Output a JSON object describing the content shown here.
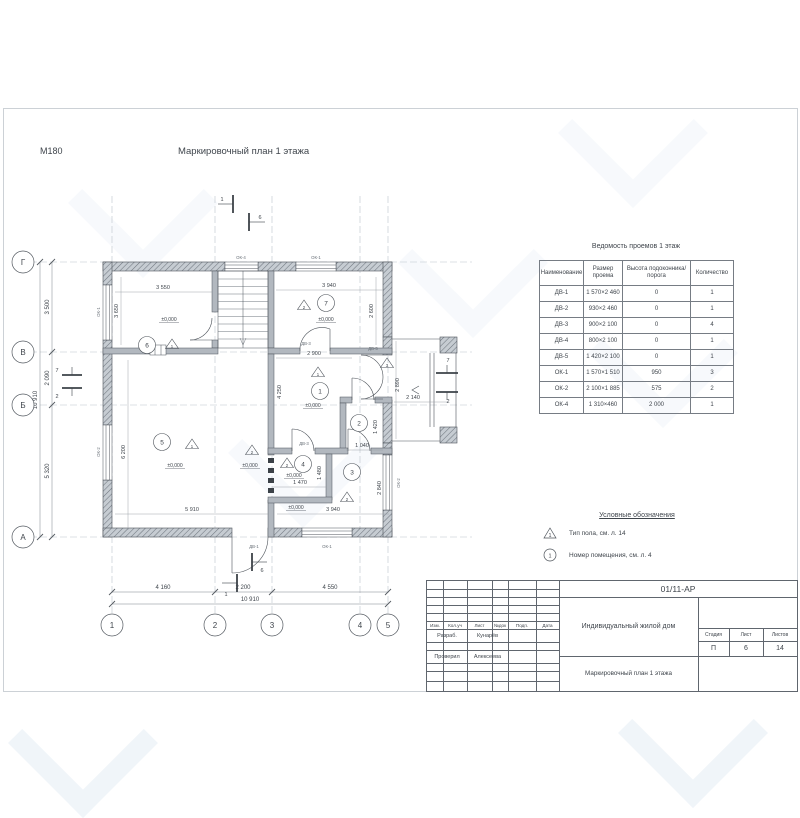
{
  "page": {
    "scale_label": "М180",
    "plan_title": "Маркировочный план 1 этажа"
  },
  "plan": {
    "axes_bottom": [
      "1",
      "2",
      "3",
      "4",
      "5"
    ],
    "axes_left": [
      "Г",
      "В",
      "Б",
      "А"
    ],
    "level": "±0,000",
    "room_numbers": [
      "1",
      "2",
      "3",
      "4",
      "5",
      "6",
      "7"
    ],
    "floor_types": [
      "1",
      "2",
      "3"
    ],
    "section_marks": {
      "s1": "1",
      "s6": "6",
      "s2": "2",
      "s7": "7"
    },
    "openings": {
      "ok1": "ОК-1",
      "ok2": "ОК-2",
      "ok4": "ОК-4",
      "dv1": "ДВ-1",
      "dv3": "ДВ-3",
      "dv5": "ДВ-5"
    },
    "dims": {
      "tl_w": "3 550",
      "tl_h": "3 650",
      "tr_w": "3 940",
      "tr_h": "2 600",
      "hall_w": "2 900",
      "hall_h": "4 250",
      "porch_h": "2 890",
      "porch_w": "2 140",
      "lobby_w": "1 040",
      "lobby_h": "1 420",
      "wc_w": "1 470",
      "wc_h": "1 480",
      "r3_h": "2 840",
      "r3_w": "3 940",
      "r5_w": "5 910",
      "r5_h": "6 200",
      "b1": "4 160",
      "b2": "2 200",
      "b3": "4 550",
      "b_total": "10 910",
      "l1": "3 500",
      "l2": "2 090",
      "l3": "5 320",
      "l_total": "10 910"
    }
  },
  "schedule_table": {
    "title": "Ведомость проемов 1 этаж",
    "headers": [
      "Наименование",
      "Размер проема",
      "Высота подоконника/порога",
      "Количество"
    ],
    "rows": [
      [
        "ДВ-1",
        "1 570×2 460",
        "0",
        "1"
      ],
      [
        "ДВ-2",
        "930×2 460",
        "0",
        "1"
      ],
      [
        "ДВ-3",
        "900×2 100",
        "0",
        "4"
      ],
      [
        "ДВ-4",
        "800×2 100",
        "0",
        "1"
      ],
      [
        "ДВ-5",
        "1 420×2 100",
        "0",
        "1"
      ],
      [
        "ОК-1",
        "1 570×1 510",
        "950",
        "3"
      ],
      [
        "ОК-2",
        "2 100×1 885",
        "575",
        "2"
      ],
      [
        "ОК-4",
        "1 310×460",
        "2 000",
        "1"
      ]
    ]
  },
  "legend": {
    "title": "Условные обозначения",
    "items": [
      {
        "symbol": "floor-type-triangle",
        "text": "Тип пола, см. л. 14"
      },
      {
        "symbol": "room-number-circle",
        "text": "Номер помещения, см. л. 4"
      }
    ]
  },
  "title_block": {
    "doc_number": "01/11-АР",
    "columns": [
      "Изм.",
      "Кол.уч",
      "Лист",
      "№док",
      "Подп.",
      "Дата"
    ],
    "rows": [
      {
        "role": "Разраб.",
        "name": "Кунарёв"
      },
      {
        "role": "Проверил",
        "name": "Алексеева"
      }
    ],
    "project_name": "Индивидуальный жилой дом",
    "drawing_title": "Маркировочный план 1 этажа",
    "stage_label": "Стадия",
    "sheet_label": "Лист",
    "sheets_label": "Листов",
    "stage": "П",
    "sheet_number": "6",
    "sheets_total": "14"
  }
}
